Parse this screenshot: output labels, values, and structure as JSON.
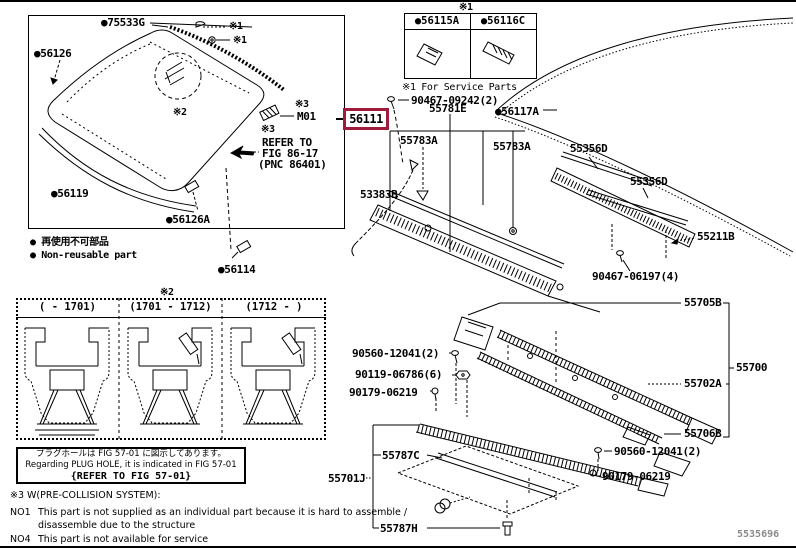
{
  "colors": {
    "highlight": "#9E1B3C",
    "ink": "#000000",
    "background": "#FFFFFF",
    "page_code_gray": "#8A8A8A"
  },
  "highlight": {
    "part": "56111"
  },
  "labels": {
    "p75533g": "●75533G",
    "p56126": "●56126",
    "p56119": "●56119",
    "p56126a": "●56126A",
    "p56114": "●56114",
    "x1": "※1",
    "x2": "※2",
    "x3": "※3",
    "m01": "M01",
    "refer_to": "REFER TO",
    "fig8617": "FIG 86-17",
    "pnc": "(PNC 86401)",
    "p90467_09242": "90467-09242(2)",
    "p56117a": "●56117A",
    "p55781e": "55781E",
    "p55783a": "55783A",
    "p53383b": "53383B",
    "p55356d": "55356D",
    "p55211b": "55211B",
    "p90467_06197": "90467-06197(4)",
    "p55705b": "55705B",
    "p55700": "55700",
    "p55702a": "55702A",
    "p55706b": "55706B",
    "p90560_12041": "90560-12041(2)",
    "p90119_06786": "90119-06786(6)",
    "p90179_06219": "90179-06219",
    "p55701j": "55701J",
    "p55787c": "55787C",
    "p55787h": "55787H"
  },
  "legend": {
    "jp": "● 再使用不可部品",
    "en": "● Non-reusable part"
  },
  "service_box": {
    "marker": "※1",
    "cell1": "●56115A",
    "cell2": "●56116C",
    "caption": "※1 For Service Parts"
  },
  "variant_box": {
    "marker": "※2",
    "h1": "(    - 1701)",
    "h2": "(1701 - 1712)",
    "h3": "(1712 -    )"
  },
  "plug_note": {
    "jp": "プラグホールは FIG 57-01 に図示してあります。",
    "en": "Regarding PLUG HOLE, it is indicated in FIG 57-01",
    "refer": "{REFER TO FIG 57-01}"
  },
  "footnotes": {
    "x3": "※3 W(PRE-COLLISION SYSTEM):",
    "no1": "NO1",
    "no1_line1": "This part is not supplied as an individual part because it is hard to assemble /",
    "no1_line2": "disassemble due to the structure",
    "no4": "NO4",
    "no4_line1": "This part is not available for service"
  },
  "page_code": "5535696"
}
